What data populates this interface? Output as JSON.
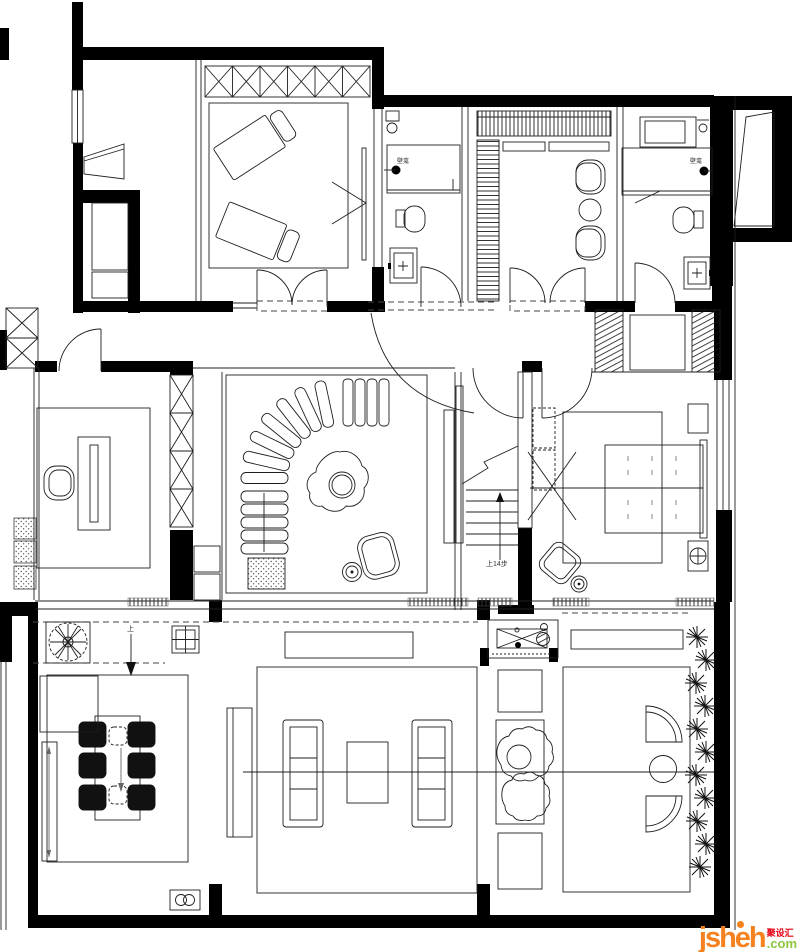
{
  "annotations": {
    "niche_left": "壁龛",
    "niche_right": "壁龛",
    "stairs_up": "上14步",
    "entry_up": "上"
  },
  "watermark": {
    "brand": "jsheh",
    "suffix": ".com",
    "cn_name": "聚设汇"
  },
  "colors": {
    "line": "#1f1f1f",
    "wall": "#000000",
    "paper": "#ffffff",
    "wm_orange": "#f6821f",
    "wm_green": "#8cc63f",
    "wm_red": "#e60012"
  }
}
